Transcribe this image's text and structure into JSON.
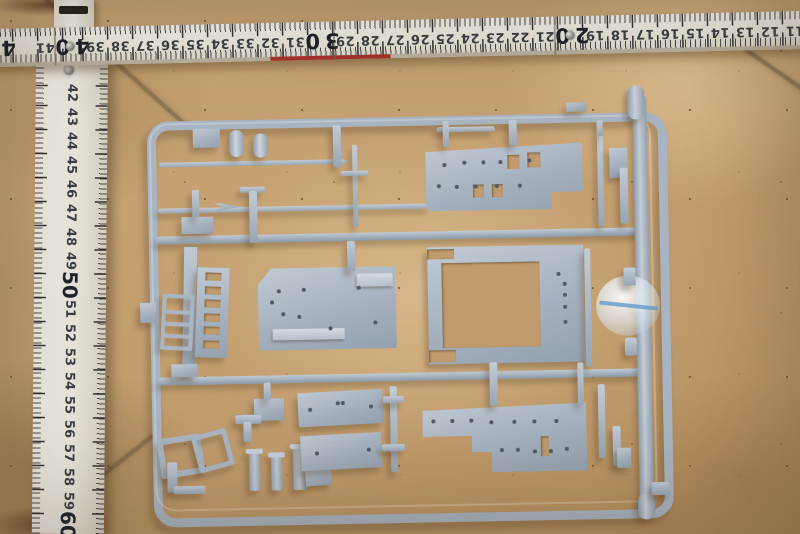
{
  "scene": {
    "subject": "model kit sprue with grey-blue plastic parts on tan tile floor, measured by white folding ruler",
    "floor_color": "#c5a072",
    "grout_color": "#68563c",
    "plastic_color": "#a9b5c2",
    "ruler_color": "#f2efe7",
    "red_edge_color": "#a8322a",
    "blob_line_color": "#5a96c8"
  },
  "ruler_horizontal": {
    "numbers": [
      41,
      40,
      39,
      38,
      37,
      36,
      35,
      34,
      33,
      32,
      31,
      30,
      29,
      28,
      27,
      26,
      25,
      24,
      23,
      22,
      21,
      20,
      19,
      18,
      17,
      16,
      15,
      14,
      13,
      12,
      11
    ],
    "major": [
      40,
      30,
      20
    ],
    "edge_digit": "4",
    "origin_value": 40,
    "origin_x_px": 80,
    "px_per_cm": 25,
    "rivet_values": [
      40,
      20
    ],
    "seams_x_px": [
      64,
      343,
      564
    ],
    "red_strip": {
      "x": 280,
      "w": 120
    }
  },
  "ruler_vertical": {
    "numbers": [
      42,
      43,
      44,
      45,
      46,
      47,
      48,
      49,
      50,
      51,
      52,
      53,
      54,
      55,
      56,
      57,
      58,
      59,
      60
    ],
    "major": [
      50,
      60
    ],
    "origin_value": 42,
    "origin_y_px": 35,
    "px_per_cm": 24,
    "hinge_rivet": {
      "x": 33,
      "y": 12
    }
  },
  "sprue": {
    "rails": [
      {
        "name": "mid-rail-upper",
        "x": 157,
        "y": 232,
        "w": 488,
        "h": 8
      },
      {
        "name": "mid-rail-lower",
        "x": 157,
        "y": 373,
        "w": 488,
        "h": 8
      },
      {
        "name": "right-runner",
        "x": 636,
        "y": 98,
        "w": 14,
        "h": 412,
        "thick": true
      }
    ],
    "parts": [
      {
        "name": "mast-rod-long",
        "kind": "rod",
        "x": 162,
        "y": 158,
        "w": 190,
        "h": 5,
        "clip": "polygon(0 0,96% 0,100% 50%,96% 100%,0 100%)"
      },
      {
        "name": "mast-rod-2",
        "kind": "rod",
        "x": 160,
        "y": 204,
        "w": 272,
        "h": 5
      },
      {
        "name": "spear-tip",
        "kind": "plate",
        "x": 216,
        "y": 197,
        "w": 28,
        "h": 13,
        "clip": "polygon(0 15%,100% 50%,0 85%,28% 50%)"
      },
      {
        "name": "cylinder-part-1",
        "kind": "cyl",
        "x": 232,
        "y": 127,
        "w": 15,
        "h": 27
      },
      {
        "name": "cylinder-part-2",
        "kind": "cyl",
        "x": 256,
        "y": 131,
        "w": 15,
        "h": 24
      },
      {
        "name": "tab-part-1",
        "kind": "plate",
        "x": 196,
        "y": 125,
        "w": 27,
        "h": 19
      },
      {
        "name": "vertical-rod",
        "kind": "rod",
        "x": 355,
        "y": 144,
        "w": 5,
        "h": 82
      },
      {
        "name": "crossbar",
        "kind": "rod",
        "x": 343,
        "y": 170,
        "w": 28,
        "h": 5
      },
      {
        "name": "t-rod-cap",
        "kind": "rod",
        "x": 242,
        "y": 184,
        "w": 25,
        "h": 6
      },
      {
        "name": "t-rod-stem",
        "kind": "rod",
        "x": 251,
        "y": 188,
        "w": 8,
        "h": 52
      },
      {
        "name": "small-plate-1",
        "kind": "plate",
        "x": 183,
        "y": 213,
        "w": 32,
        "h": 17
      },
      {
        "name": "small-bar-1",
        "kind": "rod",
        "x": 194,
        "y": 186,
        "w": 7,
        "h": 28
      },
      {
        "name": "thin-rod-top",
        "kind": "rod",
        "x": 440,
        "y": 128,
        "w": 58,
        "h": 5
      },
      {
        "name": "deck-plate-top-right",
        "kind": "plate",
        "x": 428,
        "y": 146,
        "w": 157,
        "h": 66,
        "clip": "polygon(0 10%,100% 0,100% 74%,80% 74%,80% 100%,2% 100%,0 88%)",
        "holes": [
          [
            0.12,
            0.3
          ],
          [
            0.25,
            0.28
          ],
          [
            0.37,
            0.28
          ],
          [
            0.48,
            0.28
          ],
          [
            0.66,
            0.26
          ],
          [
            0.08,
            0.62
          ],
          [
            0.2,
            0.64
          ],
          [
            0.32,
            0.64
          ],
          [
            0.45,
            0.64
          ],
          [
            0.6,
            0.64
          ]
        ],
        "cutouts": [
          [
            0.52,
            0.16,
            0.08,
            0.22
          ],
          [
            0.65,
            0.14,
            0.08,
            0.22
          ],
          [
            0.3,
            0.6,
            0.07,
            0.2
          ],
          [
            0.42,
            0.6,
            0.07,
            0.2
          ]
        ]
      },
      {
        "name": "strip-right-1",
        "kind": "rod",
        "x": 600,
        "y": 138,
        "w": 6,
        "h": 92
      },
      {
        "name": "bracket-right",
        "kind": "plate",
        "x": 612,
        "y": 152,
        "w": 18,
        "h": 30
      },
      {
        "name": "strip-right-2",
        "kind": "rod",
        "x": 622,
        "y": 172,
        "w": 8,
        "h": 56
      },
      {
        "name": "long-strip-left",
        "kind": "plate",
        "x": 183,
        "y": 243,
        "w": 13,
        "h": 128,
        "rot": 2
      },
      {
        "name": "slatted-wall",
        "kind": "plate",
        "x": 196,
        "y": 264,
        "w": 32,
        "h": 90,
        "rot": 3,
        "cutouts": [
          [
            0.25,
            0.06,
            0.5,
            0.09
          ],
          [
            0.25,
            0.21,
            0.5,
            0.09
          ],
          [
            0.25,
            0.36,
            0.5,
            0.09
          ],
          [
            0.25,
            0.51,
            0.5,
            0.09
          ],
          [
            0.25,
            0.66,
            0.5,
            0.09
          ],
          [
            0.25,
            0.81,
            0.5,
            0.09
          ]
        ]
      },
      {
        "name": "ladder-part",
        "kind": "ladder",
        "x": 161,
        "y": 290,
        "w": 24,
        "h": 48,
        "rot": 4,
        "rungs": 3
      },
      {
        "name": "tab-on-left-rail",
        "kind": "plate",
        "x": 140,
        "y": 298,
        "w": 16,
        "h": 20
      },
      {
        "name": "deck-plate-mid-left",
        "kind": "plate",
        "x": 258,
        "y": 266,
        "w": 138,
        "h": 82,
        "clip": "polygon(10% 0,100% 0,100% 100%,0 100%,0 20%)",
        "holes": [
          [
            0.1,
            0.42
          ],
          [
            0.15,
            0.28
          ],
          [
            0.18,
            0.56
          ],
          [
            0.33,
            0.27
          ],
          [
            0.3,
            0.6
          ],
          [
            0.52,
            0.74
          ],
          [
            0.73,
            0.26
          ],
          [
            0.85,
            0.68
          ]
        ],
        "ridges": [
          [
            0.72,
            0.08,
            0.26,
            0.17
          ],
          [
            0.1,
            0.74,
            0.52,
            0.14
          ]
        ]
      },
      {
        "name": "open-frame-deck",
        "kind": "plate",
        "x": 428,
        "y": 248,
        "w": 156,
        "h": 117,
        "holes": [
          [
            0.88,
            0.33
          ],
          [
            0.88,
            0.43
          ],
          [
            0.88,
            0.53
          ],
          [
            0.88,
            0.66
          ],
          [
            0.84,
            0.25
          ]
        ],
        "cutouts": [
          [
            0.09,
            0.14,
            0.63,
            0.72
          ],
          [
            0,
            0.02,
            0.17,
            0.08
          ],
          [
            0,
            0.88,
            0.17,
            0.1
          ]
        ]
      },
      {
        "name": "clear-blob",
        "kind": "blob",
        "x": 596,
        "y": 280,
        "w": 64,
        "h": 60
      },
      {
        "name": "strip-right-3",
        "kind": "rod",
        "x": 585,
        "y": 252,
        "w": 6,
        "h": 118
      },
      {
        "name": "rail-stub-1",
        "kind": "rod",
        "x": 624,
        "y": 272,
        "w": 12,
        "h": 18
      },
      {
        "name": "rail-stub-2",
        "kind": "rod",
        "x": 624,
        "y": 342,
        "w": 12,
        "h": 18
      },
      {
        "name": "tab-on-mid-rail",
        "kind": "plate",
        "x": 170,
        "y": 360,
        "w": 26,
        "h": 13
      },
      {
        "name": "square-frame-1",
        "kind": "frame",
        "x": 156,
        "y": 432,
        "w": 32,
        "h": 28,
        "rot": -8,
        "bw": 6
      },
      {
        "name": "square-frame-2",
        "kind": "frame",
        "x": 192,
        "y": 428,
        "w": 26,
        "h": 28,
        "rot": -14,
        "bw": 5
      },
      {
        "name": "elbow-rod-v",
        "kind": "rod",
        "x": 164,
        "y": 458,
        "w": 10,
        "h": 30
      },
      {
        "name": "elbow-rod-h",
        "kind": "rod",
        "x": 170,
        "y": 482,
        "w": 32,
        "h": 8
      },
      {
        "name": "small-rect-part",
        "kind": "plate",
        "x": 252,
        "y": 396,
        "w": 30,
        "h": 22
      },
      {
        "name": "stub-to-rect",
        "kind": "rod",
        "x": 262,
        "y": 380,
        "w": 7,
        "h": 18
      },
      {
        "name": "valve-cap",
        "kind": "rod",
        "x": 233,
        "y": 412,
        "w": 26,
        "h": 9
      },
      {
        "name": "valve-stem",
        "kind": "rod",
        "x": 241,
        "y": 419,
        "w": 8,
        "h": 20
      },
      {
        "name": "post-1",
        "kind": "post",
        "x": 246,
        "y": 446,
        "w": 11,
        "h": 42
      },
      {
        "name": "post-2",
        "kind": "post",
        "x": 268,
        "y": 450,
        "w": 11,
        "h": 38
      },
      {
        "name": "post-3",
        "kind": "post",
        "x": 290,
        "y": 442,
        "w": 13,
        "h": 46
      },
      {
        "name": "small-rect-2",
        "kind": "plate",
        "x": 302,
        "y": 464,
        "w": 26,
        "h": 20,
        "rot": -3
      },
      {
        "name": "deck-small-a",
        "kind": "plate",
        "x": 296,
        "y": 390,
        "w": 85,
        "h": 34,
        "rot": -2,
        "holes": [
          [
            0.14,
            0.5
          ],
          [
            0.86,
            0.5
          ],
          [
            0.47,
            0.35
          ],
          [
            0.53,
            0.35
          ]
        ]
      },
      {
        "name": "deck-small-b",
        "kind": "plate",
        "x": 298,
        "y": 433,
        "w": 81,
        "h": 35,
        "rot": -2,
        "holes": [
          [
            0.2,
            0.52
          ],
          [
            0.84,
            0.48
          ]
        ]
      },
      {
        "name": "vertical-runner-small",
        "kind": "rod",
        "x": 388,
        "y": 386,
        "w": 7,
        "h": 86
      },
      {
        "name": "runner-cap-1",
        "kind": "rod",
        "x": 381,
        "y": 396,
        "w": 21,
        "h": 7
      },
      {
        "name": "runner-cap-2",
        "kind": "rod",
        "x": 379,
        "y": 444,
        "w": 23,
        "h": 7
      },
      {
        "name": "deck-plate-bottom-right",
        "kind": "plate",
        "x": 420,
        "y": 406,
        "w": 164,
        "h": 68,
        "clip": "polygon(0 8%,100% 0,100% 100%,42% 100%,42% 70%,30% 70%,30% 46%,0 46%)",
        "holes": [
          [
            0.07,
            0.24
          ],
          [
            0.18,
            0.24
          ],
          [
            0.3,
            0.24
          ],
          [
            0.42,
            0.26
          ],
          [
            0.56,
            0.26
          ],
          [
            0.68,
            0.26
          ],
          [
            0.82,
            0.26
          ],
          [
            0.48,
            0.68
          ],
          [
            0.58,
            0.68
          ],
          [
            0.68,
            0.7
          ],
          [
            0.78,
            0.7
          ],
          [
            0.88,
            0.68
          ]
        ],
        "cutouts": [
          [
            0.72,
            0.48,
            0.05,
            0.3
          ]
        ]
      },
      {
        "name": "strip-br-1",
        "kind": "rod",
        "x": 596,
        "y": 388,
        "w": 7,
        "h": 74
      },
      {
        "name": "strip-br-2",
        "kind": "rod",
        "x": 610,
        "y": 430,
        "w": 8,
        "h": 40
      },
      {
        "name": "small-sq-br",
        "kind": "plate",
        "x": 614,
        "y": 452,
        "w": 14,
        "h": 20
      },
      {
        "name": "runner-stub-top",
        "kind": "cyl",
        "x": 631,
        "y": 90,
        "w": 17,
        "h": 34
      },
      {
        "name": "runner-stub-bottom",
        "kind": "cyl",
        "x": 634,
        "y": 498,
        "w": 17,
        "h": 26
      },
      {
        "name": "runner-stub-right",
        "kind": "rod",
        "x": 648,
        "y": 487,
        "w": 18,
        "h": 13
      },
      {
        "name": "top-rail-tab",
        "kind": "plate",
        "x": 570,
        "y": 106,
        "w": 20,
        "h": 9
      },
      {
        "name": "connector-stub-1",
        "kind": "rod",
        "x": 336,
        "y": 124,
        "w": 8,
        "h": 42
      },
      {
        "name": "connector-stub-2",
        "kind": "rod",
        "x": 348,
        "y": 240,
        "w": 8,
        "h": 30
      },
      {
        "name": "connector-stub-3",
        "kind": "rod",
        "x": 446,
        "y": 122,
        "w": 6,
        "h": 26
      },
      {
        "name": "connector-stub-4",
        "kind": "rod",
        "x": 512,
        "y": 122,
        "w": 8,
        "h": 26
      },
      {
        "name": "connector-stub-5",
        "kind": "rod",
        "x": 600,
        "y": 124,
        "w": 6,
        "h": 16
      },
      {
        "name": "connector-stub-6",
        "kind": "rod",
        "x": 488,
        "y": 364,
        "w": 8,
        "h": 44
      },
      {
        "name": "connector-stub-7",
        "kind": "rod",
        "x": 576,
        "y": 366,
        "w": 6,
        "h": 42
      }
    ]
  },
  "grout_lines": [
    {
      "x": 40,
      "y": -8,
      "len": 200,
      "deg": 42
    },
    {
      "x": 58,
      "y": 508,
      "len": 130,
      "deg": -38
    },
    {
      "x": 738,
      "y": 42,
      "len": 95,
      "deg": 35
    }
  ],
  "dark_patches": [
    {
      "x": -10,
      "y": -6,
      "w": 110,
      "h": 22
    },
    {
      "x": -15,
      "y": 505,
      "w": 130,
      "h": 40
    }
  ]
}
